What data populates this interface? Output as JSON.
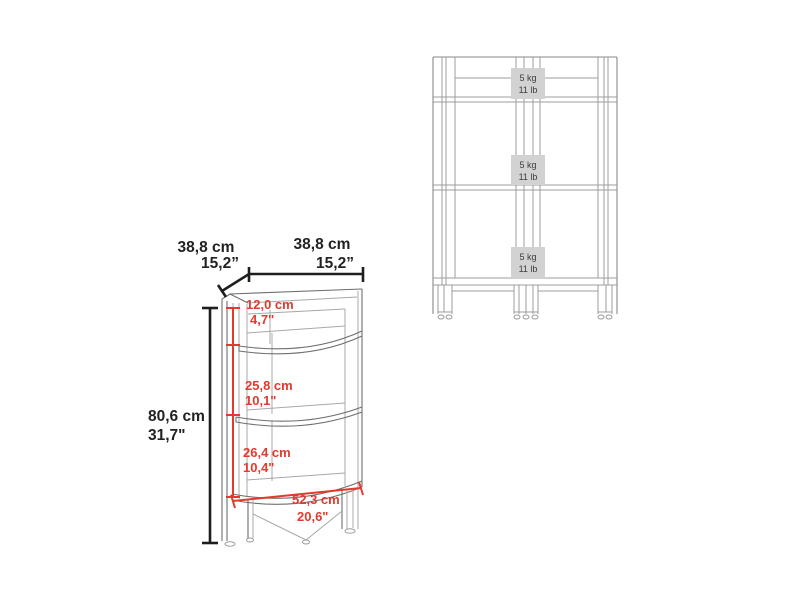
{
  "figure": {
    "title_hint": "corner shelf dimensional drawing",
    "colors": {
      "dimension_red": "#e23a2e",
      "dimension_black": "#1e1e1e",
      "drawing_gray": "#9d9d9d",
      "capacity_box_bg": "#d2d2d2",
      "background": "#ffffff"
    },
    "perspective_view": {
      "top_depth": {
        "cm": "38,8 cm",
        "inch": "15,2”"
      },
      "top_width": {
        "cm": "38,8 cm",
        "inch": "15,2”"
      },
      "total_height": {
        "cm": "80,6 cm",
        "inch": "31,7\""
      },
      "top_section": {
        "cm": "12,0 cm",
        "inch": "4,7\""
      },
      "middle_section": {
        "cm": "25,8 cm",
        "inch": "10,1\""
      },
      "bottom_section": {
        "cm": "26,4 cm",
        "inch": "10,4\""
      },
      "shelf_diagonal": {
        "cm": "52,3 cm",
        "inch": "20,6\""
      }
    },
    "front_view": {
      "shelf_loads": [
        {
          "kg": "5 kg",
          "lb": "11 lb"
        },
        {
          "kg": "5 kg",
          "lb": "11 lb"
        },
        {
          "kg": "5 kg",
          "lb": "11 lb"
        }
      ]
    }
  }
}
